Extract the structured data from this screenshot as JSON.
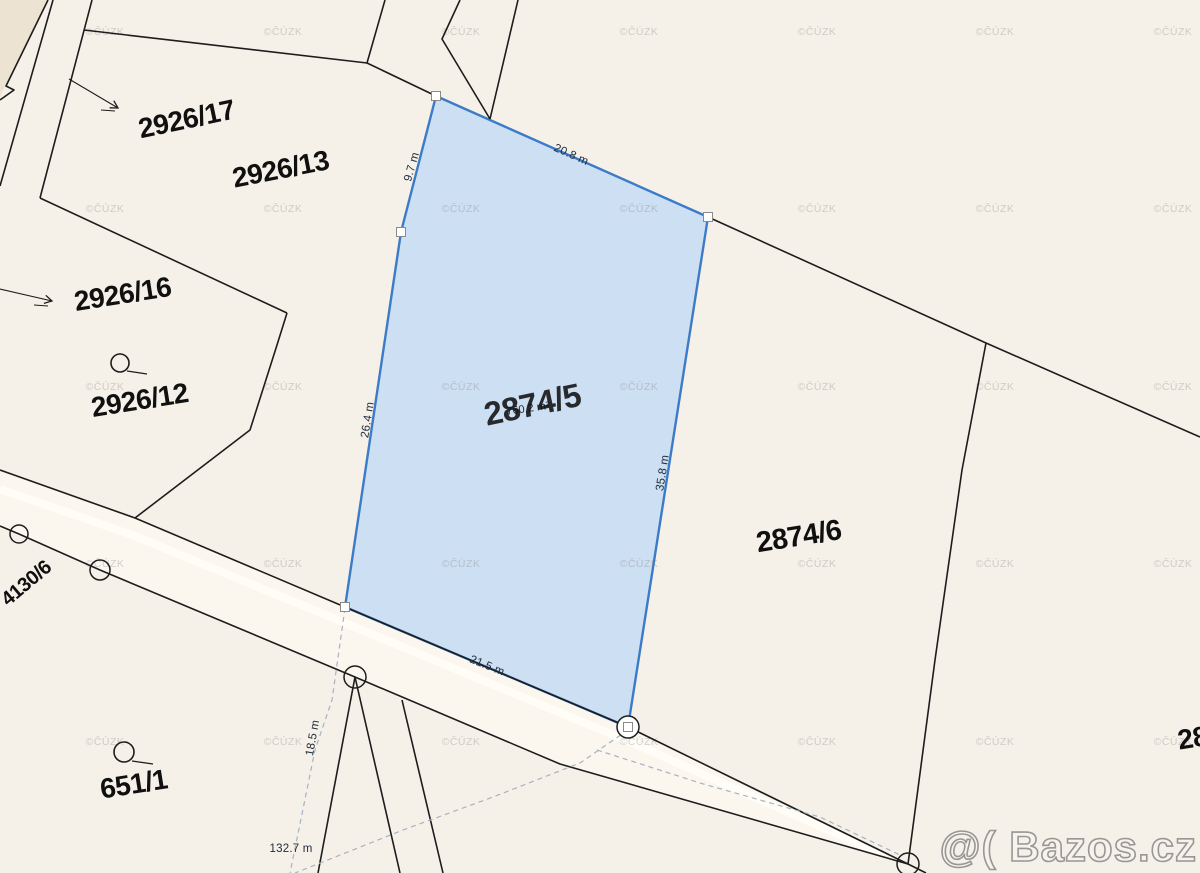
{
  "map": {
    "background": "#f6f1e8",
    "line_color": "#1d1d1d",
    "dash_color": "#a7b2c2",
    "highlighted_parcel": {
      "number": "2874/5",
      "area": "760.2 m²",
      "fill": "#c9ddf3",
      "stroke": "#3c7bc7",
      "points": [
        [
          436,
          96
        ],
        [
          708,
          217
        ],
        [
          628,
          727
        ],
        [
          345,
          607
        ],
        [
          401,
          232
        ]
      ],
      "number_pos": {
        "x": 533,
        "y": 407,
        "rot": -12,
        "size": 33
      },
      "area_pos": {
        "x": 528,
        "y": 409,
        "rot": -8,
        "size": 11
      }
    },
    "parcel_labels": [
      {
        "text": "2926/17",
        "x": 187,
        "y": 121,
        "rot": -12,
        "size": 28
      },
      {
        "text": "2926/13",
        "x": 281,
        "y": 171,
        "rot": -11,
        "size": 28
      },
      {
        "text": "2926/16",
        "x": 123,
        "y": 296,
        "rot": -9,
        "size": 28
      },
      {
        "text": "2926/12",
        "x": 140,
        "y": 402,
        "rot": -9,
        "size": 28
      },
      {
        "text": "2874/6",
        "x": 799,
        "y": 538,
        "rot": -9,
        "size": 29
      },
      {
        "text": "651/1",
        "x": 134,
        "y": 786,
        "rot": -9,
        "size": 28
      },
      {
        "text": "4130/6",
        "x": 27,
        "y": 584,
        "rot": -40,
        "size": 20
      },
      {
        "text": "28",
        "x": 1193,
        "y": 740,
        "rot": -9,
        "size": 28
      }
    ],
    "dimension_labels": [
      {
        "text": "20.8 m",
        "x": 571,
        "y": 155,
        "rot": 24
      },
      {
        "text": "9.7 m",
        "x": 412,
        "y": 167,
        "rot": -74
      },
      {
        "text": "26.4 m",
        "x": 368,
        "y": 420,
        "rot": -81
      },
      {
        "text": "35.8 m",
        "x": 663,
        "y": 473,
        "rot": -81
      },
      {
        "text": "21.5 m",
        "x": 487,
        "y": 666,
        "rot": 22
      },
      {
        "text": "18.5 m",
        "x": 313,
        "y": 738,
        "rot": -80
      },
      {
        "text": "132.7 m",
        "x": 291,
        "y": 849,
        "rot": 0
      }
    ],
    "building_area": {
      "fill": "#ece3d3",
      "points": [
        [
          0,
          0
        ],
        [
          48,
          0
        ],
        [
          6,
          86
        ],
        [
          14,
          90
        ],
        [
          0,
          100
        ]
      ]
    },
    "road": {
      "fill": "#fbf7ef",
      "band_color": "#fffdf6",
      "fill_points": [
        [
          0,
          470
        ],
        [
          135,
          518
        ],
        [
          345,
          607
        ],
        [
          628,
          727
        ],
        [
          908,
          864
        ],
        [
          560,
          764
        ],
        [
          355,
          677
        ],
        [
          100,
          570
        ],
        [
          19,
          534
        ],
        [
          0,
          526
        ]
      ],
      "band_points": [
        [
          0,
          489
        ],
        [
          135,
          536
        ],
        [
          345,
          623
        ],
        [
          628,
          741
        ],
        [
          880,
          853
        ]
      ]
    },
    "boundary_lines": [
      {
        "name": "path-strip-west",
        "points": [
          [
            53,
            0
          ],
          [
            0,
            186
          ]
        ]
      },
      {
        "name": "path-strip-east",
        "points": [
          [
            92,
            0
          ],
          [
            40,
            198
          ]
        ]
      },
      {
        "name": "building-edge",
        "points": [
          [
            48,
            0
          ],
          [
            6,
            86
          ],
          [
            14,
            90
          ],
          [
            0,
            100
          ]
        ]
      },
      {
        "name": "boundary-2926-13-north",
        "points": [
          [
            84,
            30
          ],
          [
            367,
            63
          ]
        ]
      },
      {
        "name": "top-boundary-a",
        "points": [
          [
            385,
            0
          ],
          [
            367,
            63
          ]
        ]
      },
      {
        "name": "boundary-to-parcel-corner",
        "points": [
          [
            367,
            63
          ],
          [
            436,
            96
          ]
        ]
      },
      {
        "name": "top-boundary-b",
        "points": [
          [
            460,
            0
          ],
          [
            442,
            39
          ],
          [
            490,
            119
          ]
        ]
      },
      {
        "name": "top-boundary-c",
        "points": [
          [
            518,
            0
          ],
          [
            490,
            119
          ]
        ]
      },
      {
        "name": "boundary-east",
        "points": [
          [
            708,
            217
          ],
          [
            986,
            343
          ],
          [
            1200,
            437
          ]
        ]
      },
      {
        "name": "boundary-2874-6-east",
        "points": [
          [
            986,
            343
          ],
          [
            962,
            470
          ],
          [
            935,
            660
          ],
          [
            908,
            864
          ]
        ]
      },
      {
        "name": "boundary-2926-16-north",
        "points": [
          [
            40,
            198
          ],
          [
            287,
            313
          ]
        ]
      },
      {
        "name": "boundary-2926-12-east",
        "points": [
          [
            287,
            313
          ],
          [
            277,
            345
          ],
          [
            250,
            430
          ],
          [
            135,
            518
          ]
        ]
      },
      {
        "name": "road-north-edge",
        "points": [
          [
            0,
            470
          ],
          [
            135,
            518
          ],
          [
            345,
            607
          ],
          [
            628,
            727
          ],
          [
            908,
            864
          ],
          [
            926,
            873
          ]
        ]
      },
      {
        "name": "road-south-edge",
        "points": [
          [
            0,
            526
          ],
          [
            19,
            534
          ],
          [
            100,
            570
          ],
          [
            355,
            677
          ],
          [
            560,
            764
          ],
          [
            908,
            864
          ]
        ]
      },
      {
        "name": "branch-line-west",
        "points": [
          [
            355,
            677
          ],
          [
            318,
            873
          ]
        ]
      },
      {
        "name": "branch-line-east",
        "points": [
          [
            355,
            677
          ],
          [
            400,
            873
          ]
        ]
      },
      {
        "name": "branch-line-outer",
        "points": [
          [
            402,
            700
          ],
          [
            443,
            873
          ]
        ]
      }
    ],
    "dashed_lines": [
      {
        "name": "sketch-line-vertical",
        "points": [
          [
            345,
            608
          ],
          [
            332,
            700
          ],
          [
            315,
            750
          ],
          [
            290,
            873
          ]
        ]
      },
      {
        "name": "sketch-line-southwest",
        "points": [
          [
            628,
            730
          ],
          [
            580,
            763
          ],
          [
            493,
            797
          ],
          [
            403,
            830
          ],
          [
            295,
            873
          ]
        ]
      },
      {
        "name": "sketch-line-southeast",
        "points": [
          [
            597,
            750
          ],
          [
            700,
            783
          ],
          [
            820,
            817
          ],
          [
            902,
            856
          ]
        ]
      }
    ],
    "arrows": [
      {
        "from": [
          69,
          79
        ],
        "to": [
          118,
          108
        ],
        "tick": [
          [
            101,
            110
          ],
          [
            115,
            111
          ]
        ]
      },
      {
        "from": [
          0,
          289
        ],
        "to": [
          52,
          301
        ],
        "tick": [
          [
            34,
            305
          ],
          [
            48,
            306
          ]
        ]
      }
    ],
    "boundary_point_circles": [
      {
        "cx": 19,
        "cy": 534,
        "r": 9,
        "fill": "none"
      },
      {
        "cx": 100,
        "cy": 570,
        "r": 10,
        "fill": "none"
      },
      {
        "cx": 355,
        "cy": 677,
        "r": 11,
        "fill": "none"
      },
      {
        "cx": 628,
        "cy": 727,
        "r": 11,
        "fill": "#ffffff"
      },
      {
        "cx": 908,
        "cy": 864,
        "r": 11,
        "fill": "none"
      }
    ],
    "vertex_squares": [
      [
        436,
        96
      ],
      [
        401,
        232
      ],
      [
        345,
        607
      ],
      [
        708,
        217
      ],
      [
        628,
        727
      ]
    ],
    "landmark_symbols": [
      {
        "cx": 120,
        "cy": 363,
        "r": 9,
        "tail": [
          [
            127,
            371
          ],
          [
            147,
            374
          ]
        ]
      },
      {
        "cx": 124,
        "cy": 752,
        "r": 10,
        "tail": [
          [
            132,
            761
          ],
          [
            153,
            764
          ]
        ]
      }
    ],
    "cuzk_watermark": {
      "text": "©ČÚZK",
      "columns": [
        105,
        283,
        461,
        639,
        817,
        995,
        1173
      ],
      "rows": [
        35,
        212,
        390,
        567,
        745
      ]
    },
    "bazos_watermark": {
      "text": "@( Bazos.cz",
      "x": 1197,
      "y": 861
    }
  }
}
